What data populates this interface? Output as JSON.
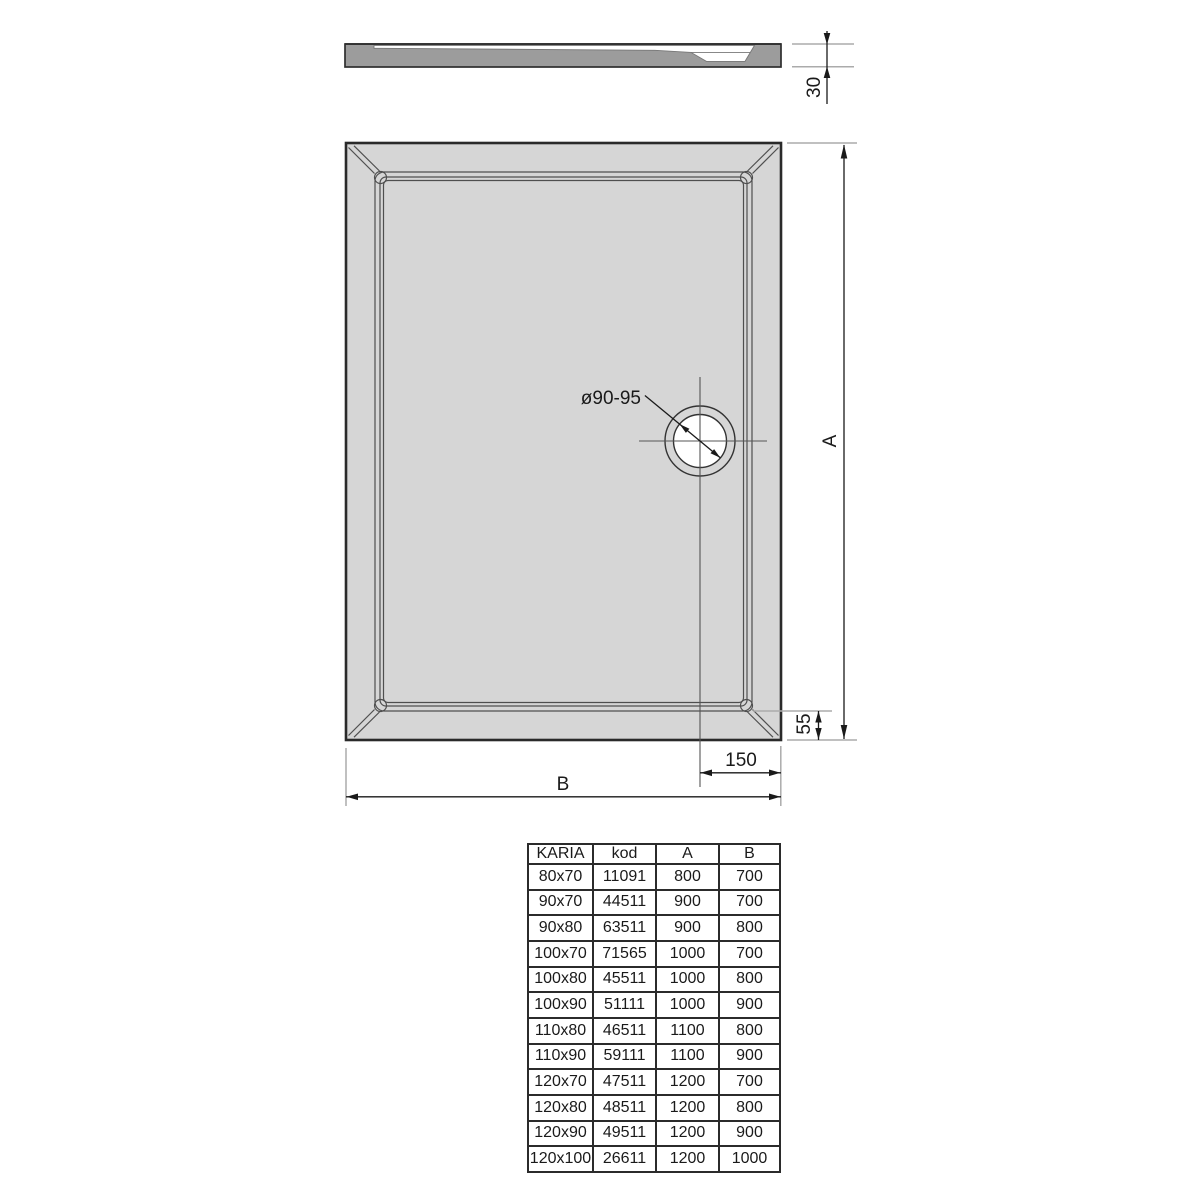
{
  "drawing": {
    "labels": {
      "thickness": "30",
      "height": "A",
      "width": "B",
      "drain_edge_offset": "55",
      "drain_right_offset": "150",
      "drain_diameter": "ø90-95"
    },
    "colors": {
      "tray_fill": "#d6d6d6",
      "section_fill": "#9c9c9c",
      "outline": "#2a2a2a",
      "extension_line": "#ababab"
    }
  },
  "table": {
    "columns": [
      "KARIA",
      "kod",
      "A",
      "B"
    ],
    "rows": [
      [
        "80x70",
        "11091",
        "800",
        "700"
      ],
      [
        "90x70",
        "44511",
        "900",
        "700"
      ],
      [
        "90x80",
        "63511",
        "900",
        "800"
      ],
      [
        "100x70",
        "71565",
        "1000",
        "700"
      ],
      [
        "100x80",
        "45511",
        "1000",
        "800"
      ],
      [
        "100x90",
        "51111",
        "1000",
        "900"
      ],
      [
        "110x80",
        "46511",
        "1100",
        "800"
      ],
      [
        "110x90",
        "59111",
        "1100",
        "900"
      ],
      [
        "120x70",
        "47511",
        "1200",
        "700"
      ],
      [
        "120x80",
        "48511",
        "1200",
        "800"
      ],
      [
        "120x90",
        "49511",
        "1200",
        "900"
      ],
      [
        "120x100",
        "26611",
        "1200",
        "1000"
      ]
    ]
  }
}
